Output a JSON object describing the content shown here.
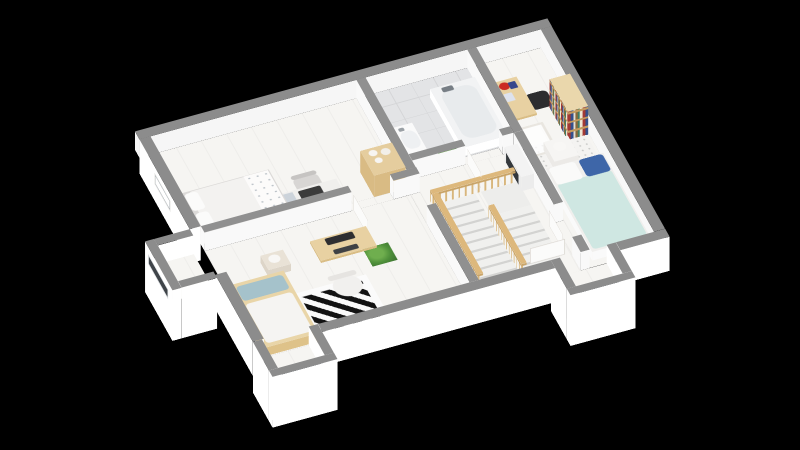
{
  "meta": {
    "description": "3D isometric floor plan rendering of an upper storey, white walls with gray tops on black background",
    "background": "#000000"
  },
  "palette": {
    "wall_top": "#8c8c8c",
    "wall_top_inner": "#909090",
    "wall_face": "#ffffff",
    "wall_face_inner": "#f8f8f8",
    "floor_wood": "#f6f5f2",
    "floor_tile": "#e3e4e6",
    "wood": "#e8d1a2",
    "wood_dark": "#d9bd85",
    "duvet_mint": "#cfe7e2",
    "pillow_navy": "#3e66a8",
    "pillow_teal": "#a5c2cb",
    "rug_black": "#121212",
    "plant_green": "#4e8f3a"
  },
  "projection": {
    "origin_x": 135,
    "origin_y": 150,
    "rotate_x_deg": 45.6,
    "rotate_z_deg": -21.4,
    "plan_width": 443,
    "plan_depth": 335,
    "wall_height": 26
  },
  "rooms": [
    "bedroom-top-left",
    "bedroom-front-left",
    "bathroom",
    "hallway-stairs",
    "bedroom-right",
    "window-bay-west",
    "window-bay-south-left",
    "window-bay-south-right"
  ],
  "scene": {
    "floors": [
      {
        "n": "floor-bedroom-top-left",
        "x": 12,
        "y": 12,
        "w": 221,
        "h": 138,
        "c": "wood"
      },
      {
        "n": "floor-bedroom-front-left",
        "x": 12,
        "y": 160,
        "w": 221,
        "h": 163,
        "c": "wood"
      },
      {
        "n": "floor-hall",
        "x": 243,
        "y": 140,
        "w": 109,
        "h": 183,
        "c": "wood"
      },
      {
        "n": "floor-bathroom",
        "x": 243,
        "y": 12,
        "w": 109,
        "h": 118,
        "c": "tile"
      },
      {
        "n": "floor-bedroom-right",
        "x": 362,
        "y": 12,
        "w": 69,
        "h": 311,
        "c": "wood"
      },
      {
        "n": "floor-door-gap-left",
        "x": 170,
        "y": 150,
        "w": 45,
        "h": 10,
        "c": "wood",
        "z": 0.06
      },
      {
        "n": "floor-door-gap-hall",
        "x": 233,
        "y": 160,
        "w": 10,
        "h": 45,
        "c": "wood",
        "z": 0.06
      },
      {
        "n": "floor-door-gap-bath",
        "x": 300,
        "y": 130,
        "w": 40,
        "h": 10,
        "c": "wood",
        "z": 0.06
      },
      {
        "n": "floor-door-gap-right",
        "x": 352,
        "y": 250,
        "w": 10,
        "h": 50,
        "c": "wood",
        "z": 0.06
      },
      {
        "n": "floor-bay-west",
        "x": -38,
        "y": 160,
        "w": 38,
        "h": 55,
        "c": "wood"
      },
      {
        "n": "floor-bay-south-left",
        "x": 10,
        "y": 323,
        "w": 50,
        "h": 44,
        "c": "wood"
      },
      {
        "n": "floor-bay-south-right",
        "x": 330,
        "y": 323,
        "w": 50,
        "h": 44,
        "c": "wood"
      }
    ],
    "boxes": [
      {
        "n": "wall-exterior-nw",
        "x": 0,
        "y": 0,
        "w": 443,
        "h": 12,
        "z0": 0,
        "z1": 26,
        "t": "#8c8c8c",
        "s": "#f6f6f6"
      },
      {
        "n": "wall-exterior-ne",
        "x": 431,
        "y": 12,
        "w": 12,
        "h": 311,
        "z0": 0,
        "z1": 26,
        "t": "#8c8c8c",
        "s": "#f8f8f8"
      },
      {
        "n": "wall-exterior-se-a",
        "x": 70,
        "y": 323,
        "w": 250,
        "h": 12,
        "z0": -22,
        "z1": 26,
        "t": "#8c8c8c",
        "s": "#ffffff"
      },
      {
        "n": "wall-exterior-se-b",
        "x": 390,
        "y": 323,
        "w": 53,
        "h": 12,
        "z0": -22,
        "z1": 26,
        "t": "#8c8c8c",
        "s": "#ffffff"
      },
      {
        "n": "wall-exterior-sw-a",
        "x": 0,
        "y": 12,
        "w": 12,
        "h": 138,
        "z0": -22,
        "z1": 26,
        "t": "#8c8c8c",
        "s": "#ffffff"
      },
      {
        "n": "wall-exterior-sw-b",
        "x": 0,
        "y": 220,
        "w": 12,
        "h": 103,
        "z0": -22,
        "z1": 26,
        "t": "#8c8c8c",
        "s": "#ffffff"
      },
      {
        "n": "bay-west-side-north",
        "x": -38,
        "y": 150,
        "w": 38,
        "h": 10,
        "z0": -45,
        "z1": 26,
        "t": "#8c8c8c",
        "s": "#ffffff"
      },
      {
        "n": "bay-west-side-south",
        "x": -38,
        "y": 215,
        "w": 38,
        "h": 10,
        "z0": -45,
        "z1": 26,
        "t": "#8c8c8c",
        "s": "#ffffff"
      },
      {
        "n": "bay-west-front",
        "x": -48,
        "y": 150,
        "w": 10,
        "h": 75,
        "z0": -45,
        "z1": 26,
        "t": "#8c8c8c",
        "s": "#ffffff"
      },
      {
        "n": "bay-south-left-side-w",
        "x": 0,
        "y": 323,
        "w": 10,
        "h": 44,
        "z0": -45,
        "z1": 26,
        "t": "#8c8c8c",
        "s": "#ffffff"
      },
      {
        "n": "bay-south-left-side-e",
        "x": 60,
        "y": 323,
        "w": 10,
        "h": 44,
        "z0": -45,
        "z1": 26,
        "t": "#8c8c8c",
        "s": "#ffffff"
      },
      {
        "n": "bay-south-left-front",
        "x": 0,
        "y": 367,
        "w": 70,
        "h": 10,
        "z0": -45,
        "z1": 26,
        "t": "#8c8c8c",
        "s": "#ffffff"
      },
      {
        "n": "bay-south-right-side-w",
        "x": 320,
        "y": 323,
        "w": 10,
        "h": 44,
        "z0": -45,
        "z1": 26,
        "t": "#8c8c8c",
        "s": "#ffffff"
      },
      {
        "n": "bay-south-right-side-e",
        "x": 380,
        "y": 323,
        "w": 10,
        "h": 44,
        "z0": -45,
        "z1": 26,
        "t": "#8c8c8c",
        "s": "#ffffff"
      },
      {
        "n": "bay-south-right-front",
        "x": 320,
        "y": 367,
        "w": 70,
        "h": 10,
        "z0": -45,
        "z1": 26,
        "t": "#8c8c8c",
        "s": "#ffffff"
      },
      {
        "n": "wall-bedroomTL-east",
        "x": 233,
        "y": 12,
        "w": 10,
        "h": 138,
        "z0": 0,
        "z1": 26,
        "t": "#909090",
        "s": "#f9f9f9"
      },
      {
        "n": "wall-divider-left",
        "x": 12,
        "y": 150,
        "w": 158,
        "h": 10,
        "z0": 0,
        "z1": 26,
        "t": "#909090",
        "s": "#f9f9f9"
      },
      {
        "n": "wall-divider-stub",
        "x": 215,
        "y": 150,
        "w": 28,
        "h": 10,
        "z0": 0,
        "z1": 26,
        "t": "#909090",
        "s": "#f9f9f9"
      },
      {
        "n": "wall-hall-west",
        "x": 233,
        "y": 205,
        "w": 10,
        "h": 118,
        "z0": 0,
        "z1": 26,
        "t": "#909090",
        "s": "#f9f9f9"
      },
      {
        "n": "wall-bathroom-east",
        "x": 352,
        "y": 12,
        "w": 10,
        "h": 128,
        "z0": 0,
        "z1": 26,
        "t": "#909090",
        "s": "#f9f9f9"
      },
      {
        "n": "wall-bathroom-south",
        "x": 243,
        "y": 130,
        "w": 57,
        "h": 10,
        "z0": 0,
        "z1": 26,
        "t": "#909090",
        "s": "#f9f9f9"
      },
      {
        "n": "wall-bathroom-south-b",
        "x": 340,
        "y": 130,
        "w": 12,
        "h": 10,
        "z0": 0,
        "z1": 26,
        "t": "#909090",
        "s": "#f9f9f9"
      },
      {
        "n": "wall-bedroomR-west-a",
        "x": 352,
        "y": 140,
        "w": 10,
        "h": 110,
        "z0": 0,
        "z1": 26,
        "t": "#909090",
        "s": "#f9f9f9"
      },
      {
        "n": "wall-bedroomR-west-b",
        "x": 352,
        "y": 300,
        "w": 10,
        "h": 23,
        "z0": 0,
        "z1": 26,
        "t": "#909090",
        "s": "#f9f9f9"
      },
      {
        "n": "bed-double-gray",
        "x": 14,
        "y": 86,
        "w": 96,
        "h": 62,
        "z0": 0,
        "z1": 12,
        "t": "#dcdad8",
        "s": "#e8e6e4"
      },
      {
        "n": "desk-top-left",
        "x": 103,
        "y": 120,
        "w": 66,
        "h": 26,
        "z0": 6,
        "z1": 9,
        "t": "#f0efed",
        "s": "#e4e2e0"
      },
      {
        "n": "shelf-cabinet-jars",
        "x": 198,
        "y": 112,
        "w": 34,
        "h": 38,
        "z0": 0,
        "z1": 30,
        "t": "#e5cd9e",
        "s": "#d9bb84"
      },
      {
        "n": "bed-single-wood",
        "x": 13,
        "y": 226,
        "w": 58,
        "h": 96,
        "z0": 0,
        "z1": 12,
        "t": "#e9d5a8",
        "s": "#dec289"
      },
      {
        "n": "desk-monitor-left",
        "x": 112,
        "y": 194,
        "w": 60,
        "h": 30,
        "z0": 6,
        "z1": 9,
        "t": "#e8d1a2",
        "s": "#d9bd85"
      },
      {
        "n": "nightstand-left",
        "x": 58,
        "y": 196,
        "w": 24,
        "h": 22,
        "z0": 0,
        "z1": 10,
        "t": "#e9e2d6",
        "s": "#ddd5c8"
      },
      {
        "n": "bath-sink-vanity",
        "x": 245,
        "y": 78,
        "w": 22,
        "h": 46,
        "z0": 0,
        "z1": 14,
        "t": "#fafafa",
        "s": "#f0f0f0"
      },
      {
        "n": "bathtub",
        "x": 302,
        "y": 38,
        "w": 48,
        "h": 90,
        "z0": 0,
        "z1": 12,
        "t": "#f2f3f4",
        "s": "#ffffff"
      },
      {
        "n": "stair-railing-north",
        "x": 248,
        "y": 176,
        "w": 92,
        "h": 6,
        "z0": 0,
        "z1": 16,
        "t": "#ddb87c",
        "s": "#d8b67c",
        "fc": "balu"
      },
      {
        "n": "stair-railing-west",
        "x": 248,
        "y": 182,
        "w": 6,
        "h": 124,
        "z0": 0,
        "z1": 16,
        "t": "#ddb87c",
        "s": "#d8b67c",
        "fc": "balu"
      },
      {
        "n": "stair-railing-mid",
        "x": 294,
        "y": 218,
        "w": 6,
        "h": 90,
        "z0": 0,
        "z1": 16,
        "t": "#ddb87c",
        "s": "#d8b67c",
        "fc": "balu"
      },
      {
        "n": "hall-cabinet",
        "x": 338,
        "y": 150,
        "w": 14,
        "h": 46,
        "z0": 0,
        "z1": 20,
        "t": "#f3f3f3",
        "s": "#ececec"
      },
      {
        "n": "desk-right",
        "x": 364,
        "y": 50,
        "w": 26,
        "h": 56,
        "z0": 6,
        "z1": 9,
        "t": "#e8d1a2",
        "s": "#d9bd85"
      },
      {
        "n": "bookshelf",
        "x": 408,
        "y": 95,
        "w": 22,
        "h": 50,
        "z0": 0,
        "z1": 40,
        "t": "#ead7ac",
        "s": "#dfc28c",
        "fc": "books"
      },
      {
        "n": "nightstand-right",
        "x": 380,
        "y": 150,
        "w": 26,
        "h": 30,
        "z0": 0,
        "z1": 12,
        "t": "#f6f5f3",
        "s": "#eceae7"
      },
      {
        "n": "bed-double-right",
        "x": 368,
        "y": 186,
        "w": 62,
        "h": 128,
        "z0": 0,
        "z1": 12,
        "t": "#f0efed",
        "s": "#fafafa"
      }
    ],
    "faces": [
      {
        "n": "door-leaf-left-rooms",
        "type": "w",
        "x": 172,
        "y": 160,
        "len": 40,
        "z0": 0,
        "z1": 22,
        "c": "door"
      },
      {
        "n": "door-leaf-bathroom",
        "type": "w",
        "x": 302,
        "y": 140,
        "len": 38,
        "z0": 0,
        "z1": 22,
        "c": "door"
      },
      {
        "n": "door-leaf-right-a",
        "type": "w",
        "x": 346,
        "y": 252,
        "len": 38,
        "z0": 0,
        "z1": 22,
        "c": "door"
      },
      {
        "n": "door-leaf-right-b",
        "type": "s",
        "x": 308,
        "y": 296,
        "len": 38,
        "z0": 0,
        "z1": 22,
        "c": "door"
      },
      {
        "n": "window-bay-west",
        "type": "w",
        "x": -48.6,
        "y": 160,
        "len": 55,
        "z0": 4,
        "z1": 18,
        "c": "wind"
      },
      {
        "n": "window-bay-south-left",
        "type": "s",
        "x": 12,
        "y": 366.4,
        "len": 46,
        "z0": 5,
        "z1": 17,
        "c": "wind"
      },
      {
        "n": "window-west-upper",
        "type": "w",
        "x": -0.6,
        "y": 55,
        "len": 44,
        "z0": 3,
        "z1": 19,
        "c": "winlite"
      },
      {
        "n": "window-bay-south-right",
        "type": "s",
        "x": 332,
        "y": 366.4,
        "len": 46,
        "z0": 5,
        "z1": 17,
        "c": "wind"
      },
      {
        "n": "hall-cabinet-dark-front",
        "type": "w",
        "x": 337.4,
        "y": 156,
        "len": 34,
        "z0": 4,
        "z1": 18,
        "col": "#34383c"
      }
    ],
    "flats": [
      {
        "n": "duvet-top-left",
        "x": 22,
        "y": 88,
        "w": 86,
        "h": 58,
        "z": 13,
        "col": "#f3f2f0",
        "r": "5px"
      },
      {
        "n": "pillow-tl-1",
        "x": 17,
        "y": 90,
        "w": 14,
        "h": 26,
        "z": 13.5,
        "col": "#fbfbfa",
        "r": "4px"
      },
      {
        "n": "pillow-tl-2",
        "x": 17,
        "y": 120,
        "w": 14,
        "h": 26,
        "z": 13.5,
        "col": "#fbfbfa",
        "r": "4px"
      },
      {
        "n": "blanket-floral",
        "x": 82,
        "y": 88,
        "w": 26,
        "h": 58,
        "z": 13.6,
        "c": "floral"
      },
      {
        "n": "laptop",
        "x": 126,
        "y": 124,
        "w": 24,
        "h": 15,
        "z": 10,
        "col": "#3b3b3b",
        "r": "2px"
      },
      {
        "n": "desk-books",
        "x": 106,
        "y": 123,
        "w": 15,
        "h": 20,
        "z": 10,
        "col": "#ccd3da"
      },
      {
        "n": "chair-top-left",
        "x": 130,
        "y": 96,
        "w": 27,
        "h": 27,
        "z": 0.8,
        "col": "#d8d6d4",
        "r": "8px"
      },
      {
        "n": "chair-top-left-back",
        "x": 130,
        "y": 93,
        "w": 27,
        "h": 6,
        "z": 0.9,
        "col": "#c6c4c2",
        "r": "3px"
      },
      {
        "n": "jar-1",
        "x": 204,
        "y": 116,
        "w": 9,
        "h": 9,
        "z": 31,
        "col": "#f7f5f2",
        "r": "50%"
      },
      {
        "n": "jar-2",
        "x": 216,
        "y": 118,
        "w": 10,
        "h": 10,
        "z": 31,
        "col": "#f2efe9",
        "r": "50%"
      },
      {
        "n": "jar-3",
        "x": 206,
        "y": 128,
        "w": 8,
        "h": 8,
        "z": 31,
        "col": "#f7f5f2",
        "r": "50%"
      },
      {
        "n": "pillow-left-teal",
        "x": 17,
        "y": 232,
        "w": 50,
        "h": 22,
        "z": 13.5,
        "col": "#a5c2cb",
        "r": "4px"
      },
      {
        "n": "duvet-left",
        "x": 17,
        "y": 258,
        "w": 50,
        "h": 60,
        "z": 13,
        "col": "#f5f4f2",
        "r": "4px"
      },
      {
        "n": "rug-geometric",
        "x": 70,
        "y": 250,
        "w": 80,
        "h": 72,
        "z": 0.5,
        "c": "ruggeo"
      },
      {
        "n": "monitor",
        "x": 126,
        "y": 197,
        "w": 30,
        "h": 10,
        "z": 10,
        "col": "#2e2e30",
        "r": "2px"
      },
      {
        "n": "keyboard",
        "x": 128,
        "y": 215,
        "w": 26,
        "h": 7,
        "z": 10.2,
        "col": "#3f4144",
        "r": "2px"
      },
      {
        "n": "chair-white-left",
        "x": 112,
        "y": 244,
        "w": 30,
        "h": 30,
        "z": 0.8,
        "col": "#f1f0ee",
        "r": "50%"
      },
      {
        "n": "chair-white-left-back",
        "x": 112,
        "y": 240,
        "w": 30,
        "h": 7,
        "z": 0.9,
        "col": "#e6e4e1",
        "r": "3px"
      },
      {
        "n": "lamp-left",
        "x": 63,
        "y": 200,
        "w": 12,
        "h": 12,
        "z": 11,
        "col": "#f8f7f5",
        "r": "50%"
      },
      {
        "n": "plant-left",
        "x": 160,
        "y": 216,
        "w": 27,
        "h": 27,
        "z": 1,
        "c": "plant"
      },
      {
        "n": "sink-basin",
        "x": 248,
        "y": 88,
        "w": 17,
        "h": 26,
        "z": 15,
        "col": "#eef0f2",
        "r": "40%"
      },
      {
        "n": "sink-faucet",
        "x": 250,
        "y": 82,
        "w": 6,
        "h": 5,
        "z": 15,
        "col": "#9aa0a5",
        "r": "2px"
      },
      {
        "n": "tub-inner",
        "x": 308,
        "y": 46,
        "w": 37,
        "h": 74,
        "z": 13,
        "col": "#e8ebed",
        "r": "12px"
      },
      {
        "n": "tub-faucet",
        "x": 312,
        "y": 42,
        "w": 12,
        "h": 7,
        "z": 13.5,
        "col": "#777e85",
        "r": "2px"
      },
      {
        "n": "plant-bath",
        "x": 280,
        "y": 114,
        "w": 20,
        "h": 20,
        "z": 1,
        "c": "plant"
      },
      {
        "n": "stair-landing",
        "x": 300,
        "y": 182,
        "w": 40,
        "h": 36,
        "z": 0.3,
        "col": "#ededeb"
      },
      {
        "n": "stair-flight-1",
        "x": 254,
        "y": 182,
        "w": 40,
        "h": 124,
        "z": 0.25,
        "c": "stairs"
      },
      {
        "n": "stair-flight-2",
        "x": 300,
        "y": 218,
        "w": 40,
        "h": 88,
        "z": 0.25,
        "c": "stairs"
      },
      {
        "n": "rug-speckled-right",
        "x": 364,
        "y": 140,
        "w": 64,
        "h": 46,
        "z": 0.5,
        "c": "speck"
      },
      {
        "n": "desk-right-red-clock",
        "x": 368,
        "y": 54,
        "w": 11,
        "h": 11,
        "z": 10,
        "col": "#cb2a22",
        "r": "50%"
      },
      {
        "n": "desk-right-frame-a",
        "x": 368,
        "y": 70,
        "w": 9,
        "h": 12,
        "z": 10,
        "col": "#dde2ee",
        "r": "1px"
      },
      {
        "n": "desk-right-frame-b",
        "x": 378,
        "y": 56,
        "w": 8,
        "h": 10,
        "z": 10,
        "col": "#37478c",
        "r": "1px"
      },
      {
        "n": "chair-black-right",
        "x": 390,
        "y": 70,
        "w": 24,
        "h": 24,
        "z": 0.8,
        "col": "#2d2d2f",
        "r": "6px"
      },
      {
        "n": "crib-white",
        "x": 364,
        "y": 112,
        "w": 30,
        "h": 44,
        "z": 0.9,
        "c": "crib"
      },
      {
        "n": "lamp-right",
        "x": 386,
        "y": 156,
        "w": 13,
        "h": 13,
        "z": 13,
        "col": "#f8f7f5",
        "r": "50%"
      },
      {
        "n": "pillow-right-white",
        "x": 370,
        "y": 188,
        "w": 28,
        "h": 26,
        "z": 13.5,
        "col": "#fafaf9",
        "r": "4px"
      },
      {
        "n": "pillow-right-navy",
        "x": 402,
        "y": 188,
        "w": 26,
        "h": 26,
        "z": 13.5,
        "col": "#3e66a8",
        "r": "4px"
      },
      {
        "n": "duvet-right-mint",
        "x": 370,
        "y": 212,
        "w": 58,
        "h": 100,
        "z": 13,
        "col": "#cfe7e2",
        "r": "4px"
      }
    ]
  }
}
